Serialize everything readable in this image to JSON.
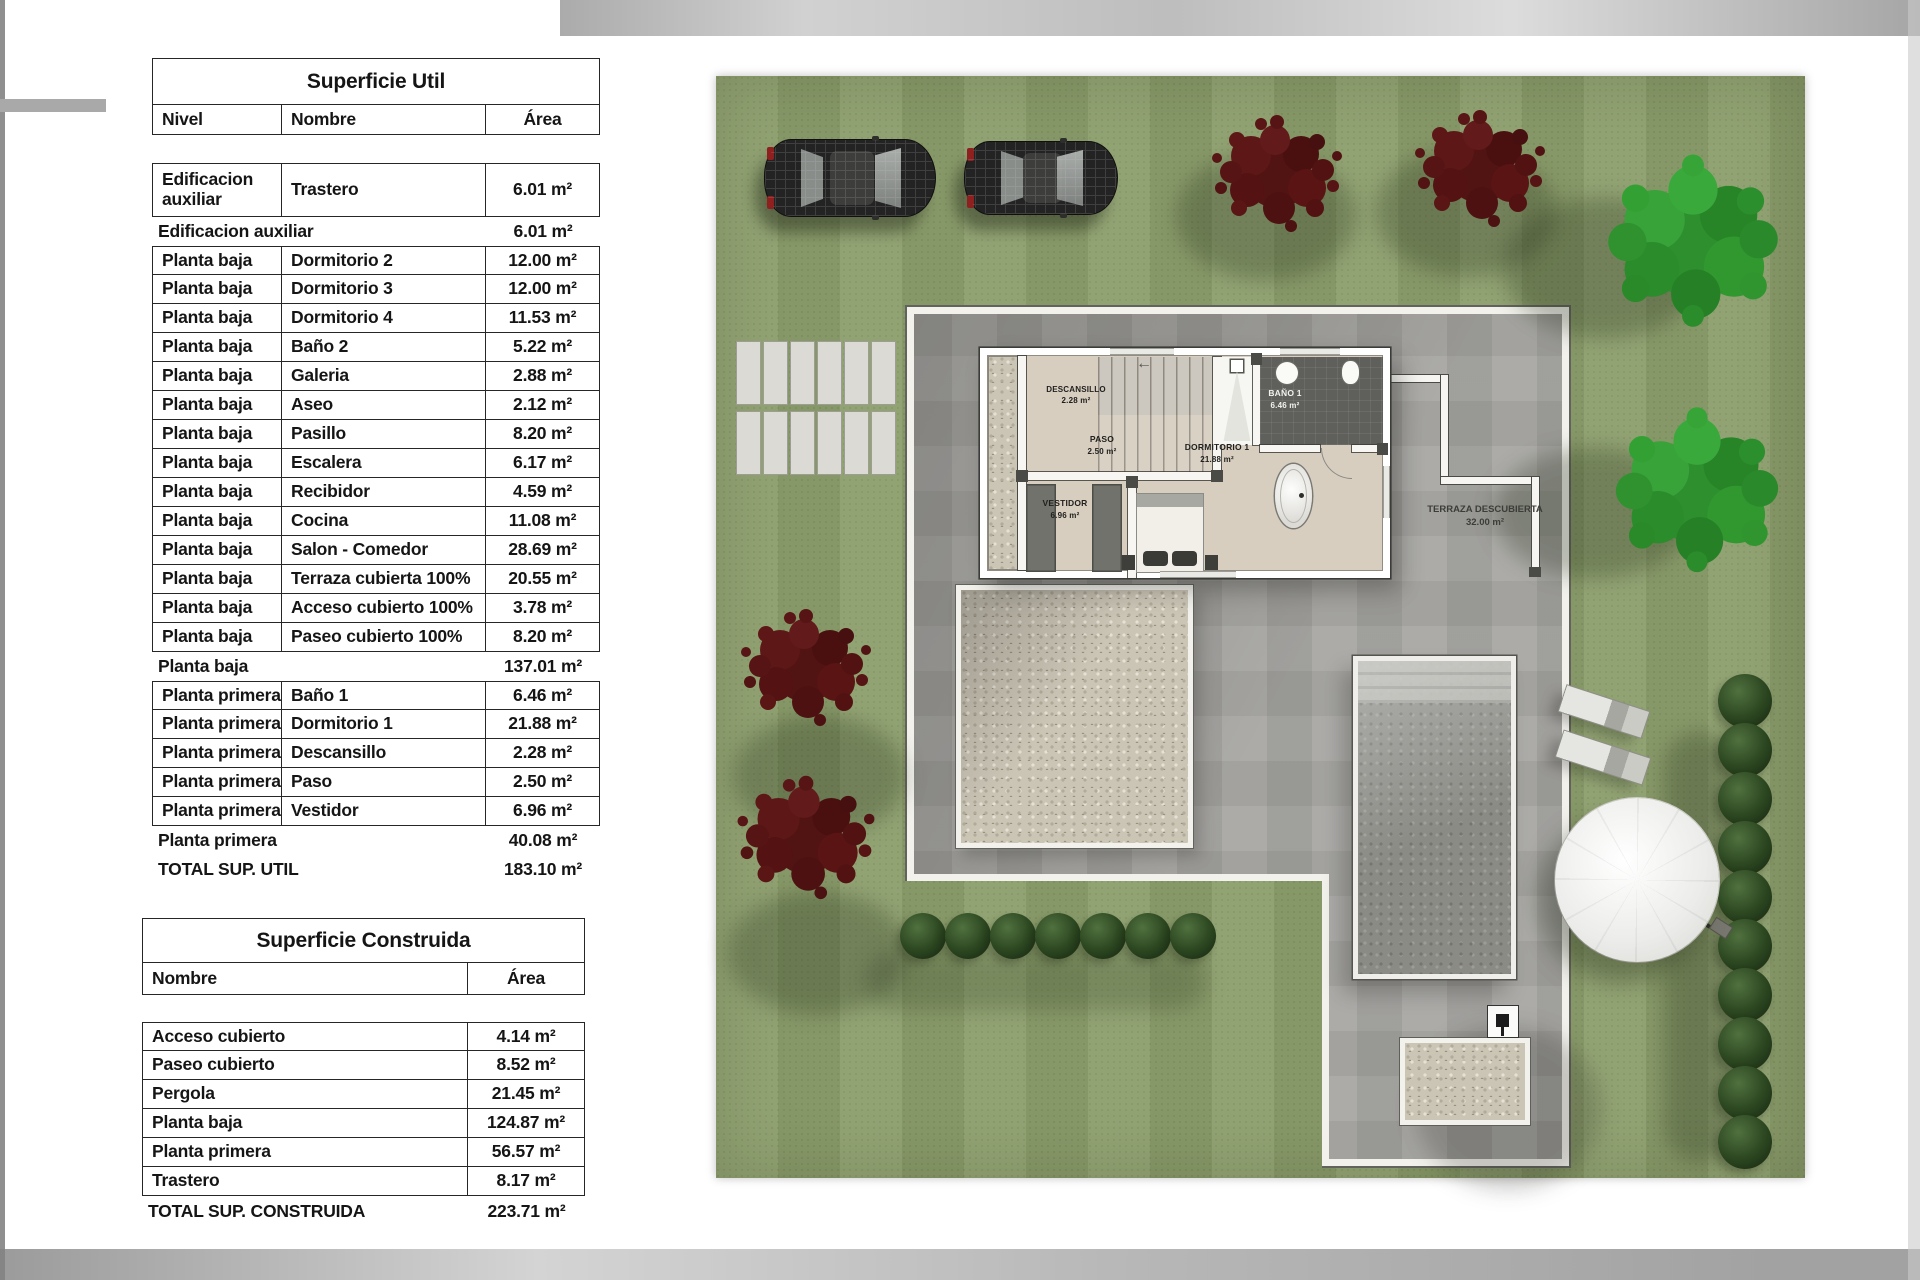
{
  "palette": {
    "grass_green": "#8c9e6c",
    "patio_gray": "#a7a6a2",
    "wall_white": "#f2f1ec",
    "gravel_beige": "#cbc5b6",
    "pool_gray": "#8b8b86",
    "floor_beige": "#d8cec0",
    "tree_red": "#551414",
    "tree_green": "#2e8f2f",
    "bush_green": "#2b4620",
    "table_line": "#262626"
  },
  "tables": {
    "util": {
      "title": "Superficie Util",
      "headers": {
        "nivel": "Nivel",
        "nombre": "Nombre",
        "area": "Área"
      },
      "rows": [
        {
          "nivel": "Edificacion auxiliar",
          "nombre": "Trastero",
          "area": "6.01 m²"
        },
        {
          "label": "Edificacion auxiliar",
          "area": "6.01 m²"
        },
        {
          "nivel": "Planta baja",
          "nombre": "Dormitorio 2",
          "area": "12.00 m²"
        },
        {
          "nivel": "Planta baja",
          "nombre": "Dormitorio 3",
          "area": "12.00 m²"
        },
        {
          "nivel": "Planta baja",
          "nombre": "Dormitorio 4",
          "area": "11.53 m²"
        },
        {
          "nivel": "Planta baja",
          "nombre": "Baño 2",
          "area": "5.22 m²"
        },
        {
          "nivel": "Planta baja",
          "nombre": "Galeria",
          "area": "2.88 m²"
        },
        {
          "nivel": "Planta baja",
          "nombre": "Aseo",
          "area": "2.12 m²"
        },
        {
          "nivel": "Planta baja",
          "nombre": "Pasillo",
          "area": "8.20 m²"
        },
        {
          "nivel": "Planta baja",
          "nombre": "Escalera",
          "area": "6.17 m²"
        },
        {
          "nivel": "Planta baja",
          "nombre": "Recibidor",
          "area": "4.59 m²"
        },
        {
          "nivel": "Planta baja",
          "nombre": "Cocina",
          "area": "11.08 m²"
        },
        {
          "nivel": "Planta baja",
          "nombre": "Salon - Comedor",
          "area": "28.69 m²"
        },
        {
          "nivel": "Planta baja",
          "nombre": "Terraza cubierta 100%",
          "area": "20.55 m²"
        },
        {
          "nivel": "Planta baja",
          "nombre": "Acceso cubierto 100%",
          "area": "3.78 m²"
        },
        {
          "nivel": "Planta baja",
          "nombre": "Paseo cubierto 100%",
          "area": "8.20 m²"
        },
        {
          "label": "Planta baja",
          "area": "137.01 m²"
        },
        {
          "nivel": "Planta primera",
          "nombre": "Baño 1",
          "area": "6.46 m²"
        },
        {
          "nivel": "Planta primera",
          "nombre": "Dormitorio 1",
          "area": "21.88 m²"
        },
        {
          "nivel": "Planta primera",
          "nombre": "Descansillo",
          "area": "2.28 m²"
        },
        {
          "nivel": "Planta primera",
          "nombre": "Paso",
          "area": "2.50 m²"
        },
        {
          "nivel": "Planta primera",
          "nombre": "Vestidor",
          "area": "6.96 m²"
        },
        {
          "label": "Planta primera",
          "area": "40.08 m²"
        },
        {
          "label": "TOTAL SUP. UTIL",
          "area": "183.10 m²"
        }
      ]
    },
    "construida": {
      "title": "Superficie Construida",
      "headers": {
        "nombre": "Nombre",
        "area": "Área"
      },
      "rows": [
        {
          "nombre": "Acceso cubierto",
          "area": "4.14 m²"
        },
        {
          "nombre": "Paseo cubierto",
          "area": "8.52 m²"
        },
        {
          "nombre": "Pergola",
          "area": "21.45 m²"
        },
        {
          "nombre": "Planta baja",
          "area": "124.87 m²"
        },
        {
          "nombre": "Planta primera",
          "area": "56.57 m²"
        },
        {
          "nombre": "Trastero",
          "area": "8.17 m²"
        }
      ],
      "total": {
        "label": "TOTAL SUP. CONSTRUIDA",
        "area": "223.71 m²"
      }
    }
  },
  "plan": {
    "rooms": {
      "descansillo": {
        "name": "DESCANSILLO",
        "area": "2.28 m²"
      },
      "bano1": {
        "name": "BAÑO 1",
        "area": "6.46 m²"
      },
      "paso": {
        "name": "PASO",
        "area": "2.50 m²"
      },
      "dormitorio1": {
        "name": "DORMITORIO 1",
        "area": "21.88 m²"
      },
      "vestidor": {
        "name": "VESTIDOR",
        "area": "6.96 m²"
      },
      "terraza": {
        "name": "TERRAZA DESCUBIERTA",
        "area": "32.00 m²"
      }
    },
    "stair_arrow": "←"
  }
}
